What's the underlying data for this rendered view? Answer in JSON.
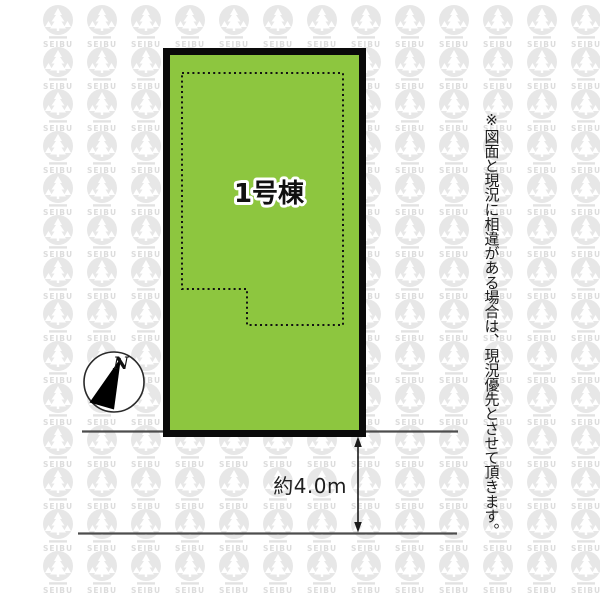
{
  "diagram": {
    "plot_label": "1号棟",
    "road_width_label": "約4.0m",
    "compass_label": "N",
    "disclaimer": "※図面と現況に相違がある場合は、現況優先とさせて頂きます。"
  },
  "watermark": {
    "brand": "SEIBU"
  },
  "colors": {
    "plot_fill": "#8dc63f",
    "plot_border": "#0a0a0a",
    "road_line": "#4d4d4d",
    "watermark_circle": "#e7e7e7",
    "watermark_text": "#dcdcdc",
    "arrow": "#1a1a1a"
  }
}
